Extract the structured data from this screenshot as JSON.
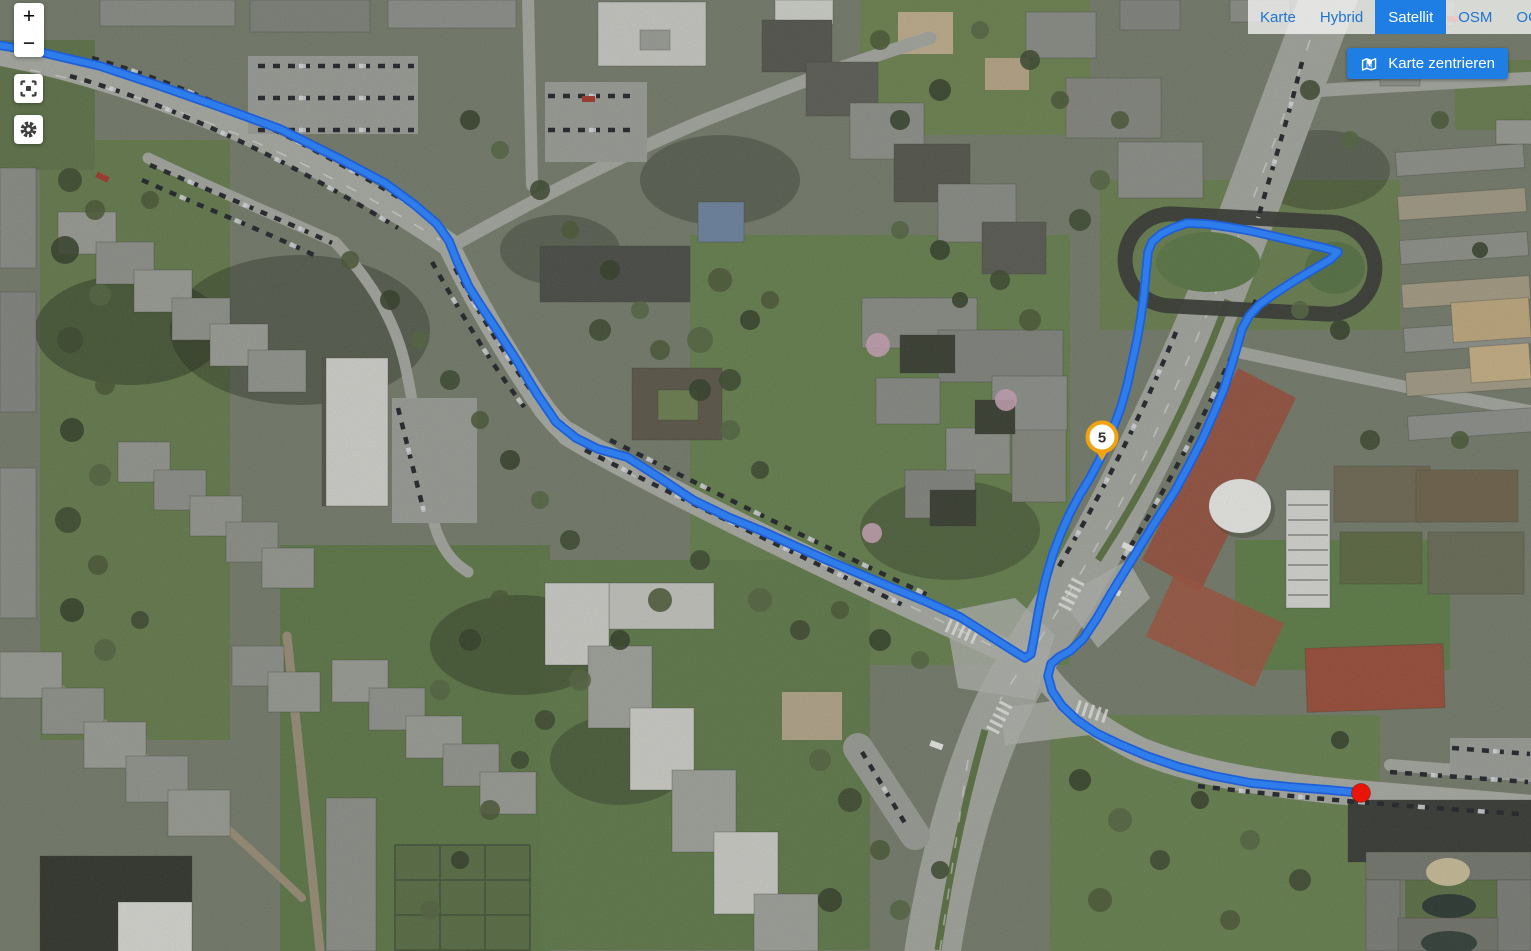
{
  "window": {
    "width": 1531,
    "height": 951
  },
  "controls": {
    "zoom_in_label": "+",
    "zoom_out_label": "−",
    "icons": {
      "fullscreen": "fullscreen-icon",
      "settings": "gear-icon",
      "center": "map-pin-icon"
    }
  },
  "layer_switcher": {
    "active": "Satellit",
    "options": [
      {
        "label": "Karte",
        "active": false
      },
      {
        "label": "Hybrid",
        "active": false
      },
      {
        "label": "Satellit",
        "active": true
      },
      {
        "label": "OSM",
        "active": false
      },
      {
        "label": "OCM",
        "active": false
      }
    ]
  },
  "center_button": {
    "label": "Karte zentrieren"
  },
  "track": {
    "color": "#2f7ceb",
    "outline_color": "#1f5fd6",
    "width": 6,
    "outline_width": 9.5,
    "points": [
      [
        -8,
        44
      ],
      [
        40,
        52
      ],
      [
        100,
        66
      ],
      [
        160,
        86
      ],
      [
        220,
        107
      ],
      [
        280,
        129
      ],
      [
        340,
        159
      ],
      [
        385,
        183
      ],
      [
        415,
        205
      ],
      [
        437,
        224
      ],
      [
        449,
        241
      ],
      [
        457,
        261
      ],
      [
        469,
        287
      ],
      [
        483,
        309
      ],
      [
        497,
        330
      ],
      [
        517,
        361
      ],
      [
        537,
        394
      ],
      [
        556,
        422
      ],
      [
        576,
        438
      ],
      [
        598,
        449
      ],
      [
        627,
        457
      ],
      [
        660,
        478
      ],
      [
        693,
        500
      ],
      [
        728,
        517
      ],
      [
        762,
        531
      ],
      [
        795,
        546
      ],
      [
        827,
        560
      ],
      [
        860,
        574
      ],
      [
        893,
        588
      ],
      [
        927,
        602
      ],
      [
        960,
        617
      ],
      [
        990,
        636
      ],
      [
        1012,
        650
      ],
      [
        1025,
        658
      ],
      [
        1031,
        654
      ],
      [
        1034,
        638
      ],
      [
        1037,
        620
      ],
      [
        1041,
        599
      ],
      [
        1046,
        578
      ],
      [
        1053,
        554
      ],
      [
        1061,
        533
      ],
      [
        1069,
        515
      ],
      [
        1079,
        496
      ],
      [
        1090,
        478
      ],
      [
        1099,
        461
      ],
      [
        1107,
        444
      ],
      [
        1114,
        426
      ],
      [
        1121,
        407
      ],
      [
        1127,
        386
      ],
      [
        1132,
        363
      ],
      [
        1137,
        340
      ],
      [
        1141,
        317
      ],
      [
        1144,
        294
      ],
      [
        1146,
        272
      ],
      [
        1148,
        252
      ],
      [
        1152,
        242
      ],
      [
        1161,
        234
      ],
      [
        1173,
        228
      ],
      [
        1187,
        223
      ],
      [
        1207,
        224
      ],
      [
        1228,
        227
      ],
      [
        1251,
        231
      ],
      [
        1277,
        237
      ],
      [
        1303,
        243
      ],
      [
        1325,
        248
      ],
      [
        1338,
        252
      ],
      [
        1331,
        259
      ],
      [
        1314,
        269
      ],
      [
        1294,
        281
      ],
      [
        1274,
        294
      ],
      [
        1259,
        305
      ],
      [
        1249,
        316
      ],
      [
        1242,
        329
      ],
      [
        1237,
        347
      ],
      [
        1231,
        367
      ],
      [
        1224,
        389
      ],
      [
        1214,
        413
      ],
      [
        1202,
        440
      ],
      [
        1189,
        465
      ],
      [
        1175,
        491
      ],
      [
        1159,
        516
      ],
      [
        1144,
        540
      ],
      [
        1128,
        566
      ],
      [
        1112,
        592
      ],
      [
        1097,
        618
      ],
      [
        1083,
        639
      ],
      [
        1070,
        651
      ],
      [
        1059,
        657
      ],
      [
        1051,
        664
      ],
      [
        1048,
        676
      ],
      [
        1052,
        691
      ],
      [
        1062,
        706
      ],
      [
        1077,
        720
      ],
      [
        1096,
        733
      ],
      [
        1119,
        744
      ],
      [
        1147,
        756
      ],
      [
        1179,
        767
      ],
      [
        1214,
        776
      ],
      [
        1251,
        783
      ],
      [
        1291,
        787
      ],
      [
        1330,
        790
      ],
      [
        1361,
        793
      ]
    ]
  },
  "marker": {
    "label": "5",
    "x": 1102,
    "y": 461,
    "ring_color": "#f0a30e",
    "fill": "#ffffff",
    "text_color": "#333333"
  },
  "endpoint": {
    "x": 1361,
    "y": 793,
    "radius": 9.5,
    "color": "#ea1509"
  }
}
